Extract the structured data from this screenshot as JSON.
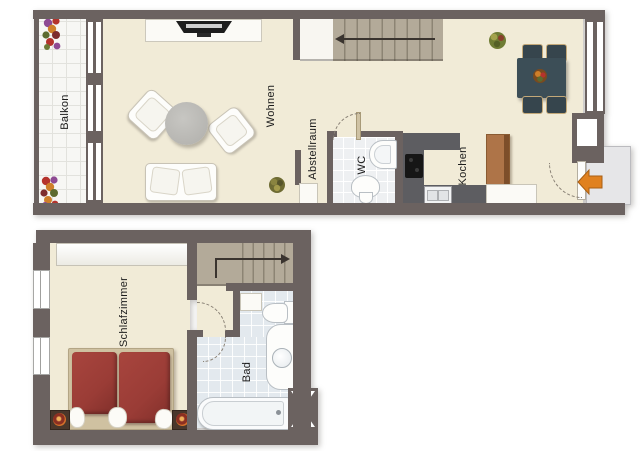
{
  "plan": {
    "upper_rooms": {
      "balkon": "Balkon",
      "wohnen": "Wohnen",
      "abstellraum": "Abstellraum",
      "wc": "WC",
      "kochen": "Kochen"
    },
    "lower_rooms": {
      "schlafzimmer": "Schlafzimmer",
      "bad": "Bad"
    }
  },
  "colors": {
    "wall": "#6b6260",
    "floor": "#f1ebd7",
    "balcony": "#f7f7f4",
    "tile_line": "#e2e2dd",
    "tile_wc": "#eef0f2",
    "tile_bath": "#e3e9ee",
    "stair": "#b3aa99",
    "stair_line": "#8c8474",
    "counter": "#5d5d61",
    "cooktop": "#161616",
    "cabinet": "#ae7448",
    "cabinet_edge": "#7d4e2a",
    "table": "#3c4e57",
    "chair": "#36454d",
    "chair_trim": "#c3a878",
    "bed": "#9a3c36",
    "bed_frame": "#cfc1a1",
    "arrow": "#e0811f",
    "arrow_edge": "#a85f14",
    "outside": "#e6e6e8",
    "label": "#1c1c1c",
    "arc": "#8a8276"
  }
}
